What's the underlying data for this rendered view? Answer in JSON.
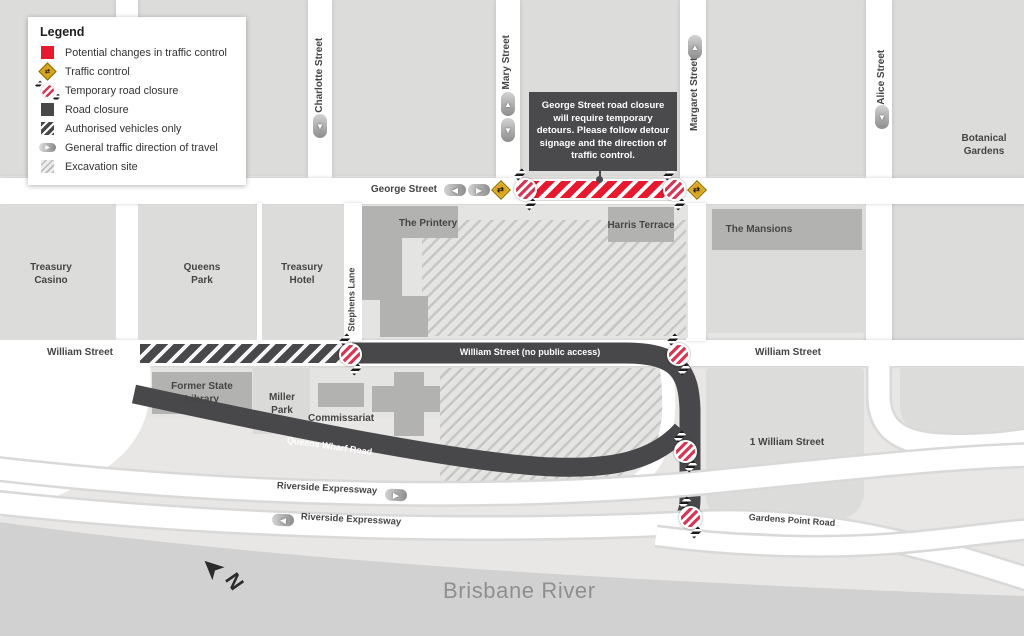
{
  "legend": {
    "title": "Legend",
    "items": [
      {
        "icon": "potential-changes-swatch",
        "label": "Potential changes in traffic control"
      },
      {
        "icon": "traffic-control-diamond",
        "label": "Traffic control"
      },
      {
        "icon": "temporary-road-closure-sign",
        "label": "Temporary road closure"
      },
      {
        "icon": "road-closure-swatch",
        "label": "Road closure"
      },
      {
        "icon": "authorised-vehicles-swatch",
        "label": "Authorised vehicles only"
      },
      {
        "icon": "traffic-direction-pill",
        "label": "General traffic direction of travel"
      },
      {
        "icon": "excavation-swatch",
        "label": "Excavation site"
      }
    ]
  },
  "callout": {
    "text": "George Street road closure will require temporary detours. Please follow detour signage and the direction of traffic control."
  },
  "streets": {
    "george": "George Street",
    "charlotte": "Charlotte Street",
    "mary": "Mary Street",
    "margaret": "Margaret Street",
    "alice": "Alice Street",
    "stephens": "Stephens Lane",
    "william_left": "William Street",
    "william_right": "William Street",
    "william_closed": "William Street (no public access)",
    "queens_wharf": "Queens Wharf Road",
    "riverside_upper": "Riverside Expressway",
    "riverside_lower": "Riverside Expressway",
    "gardens_point": "Gardens Point Road"
  },
  "places": {
    "treasury_casino": "Treasury Casino",
    "queens_park": "Queens Park",
    "treasury_hotel": "Treasury Hotel",
    "printery": "The Printery",
    "harris_terrace": "Harris Terrace",
    "mansions": "The Mansions",
    "botanical_gardens": "Botanical Gardens",
    "former_state_library": "Former State Library",
    "miller_park": "Miller Park",
    "commissariat": "Commissariat",
    "one_william_street": "1 William Street",
    "brisbane_river": "Brisbane River"
  },
  "compass_label": "N",
  "icons": {
    "arrow_up": "▲",
    "arrow_down": "▼",
    "arrow_left": "◀",
    "arrow_right": "▶",
    "compass_arrow": "➤",
    "traffic_glyph": "⇄"
  },
  "colors": {
    "closure_red": "#e6192e",
    "traffic_control_gold": "#d8a41f",
    "road_dark": "#48484a",
    "river_gray": "#d2d1d1"
  }
}
